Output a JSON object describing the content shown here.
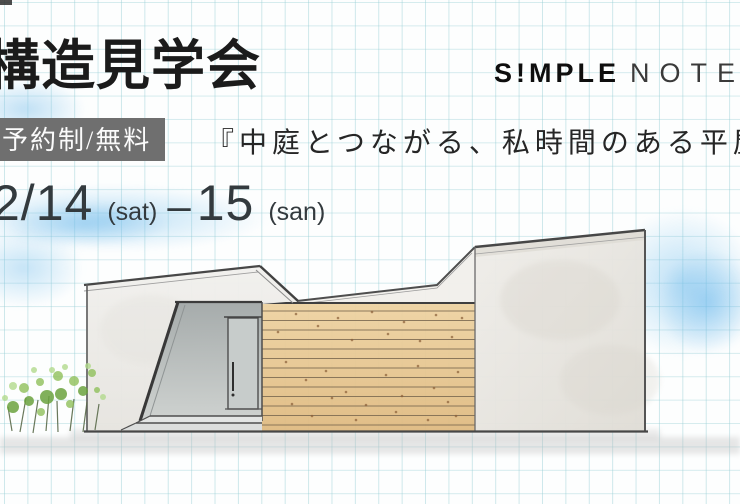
{
  "header": {
    "title": "構造見学会",
    "brand": {
      "bold": "S!MPLE",
      "light": "NOTE"
    }
  },
  "event": {
    "badge": "予約制/無料",
    "tagline": "『中庭とつながる、私時間のある平屋』",
    "date": {
      "day1": "2/14",
      "day1_label": "(sat)",
      "separator": "–",
      "day2": "15",
      "day2_label": "(san)"
    }
  },
  "illustration": {
    "description": "hand-drawn watercolor sketch of a flat-roof house with wood slat wall, entrance steps and bushes on graph paper",
    "colors": {
      "grid_line": "#94cdd4",
      "badge_bg": "#6f6f6f",
      "text": "#1b1b1b",
      "wood": "#e6c391",
      "wall": "#edebe6",
      "sky_wash": "#8ac4ea",
      "ground_wash": "#bcbcbc",
      "bush_green": "#8fbf5a"
    }
  }
}
